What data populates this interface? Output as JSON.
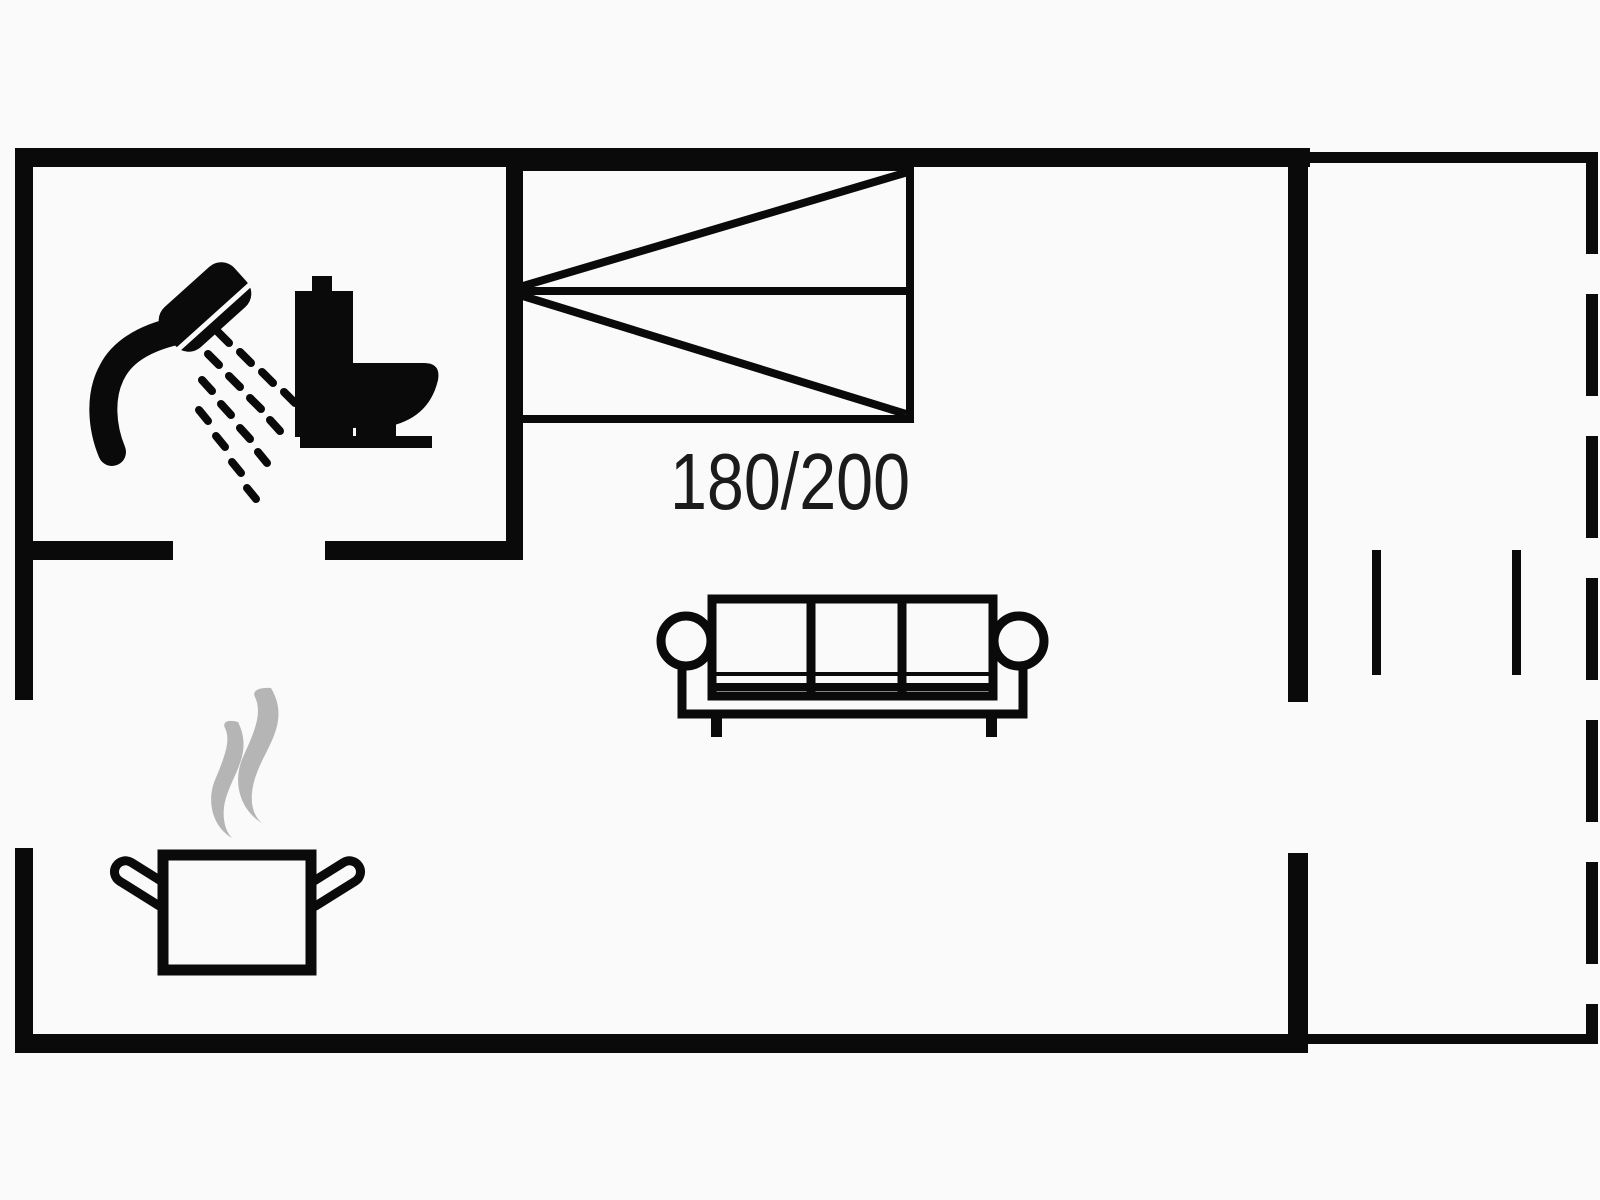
{
  "colors": {
    "wall": "#0a0a0a",
    "steam": "#b5b5b5",
    "fixture_fill": "#fafafa",
    "label": "#1b1b1b",
    "background": "#fafafa"
  },
  "floorplan": {
    "bed_size_label": "180/200",
    "icons": [
      {
        "name": "shower-icon"
      },
      {
        "name": "toilet-icon"
      },
      {
        "name": "double-bed-icon"
      },
      {
        "name": "sofa-icon"
      },
      {
        "name": "cooking-pot-icon"
      },
      {
        "name": "steam-icon"
      },
      {
        "name": "terrace-dashed-edge"
      }
    ]
  }
}
